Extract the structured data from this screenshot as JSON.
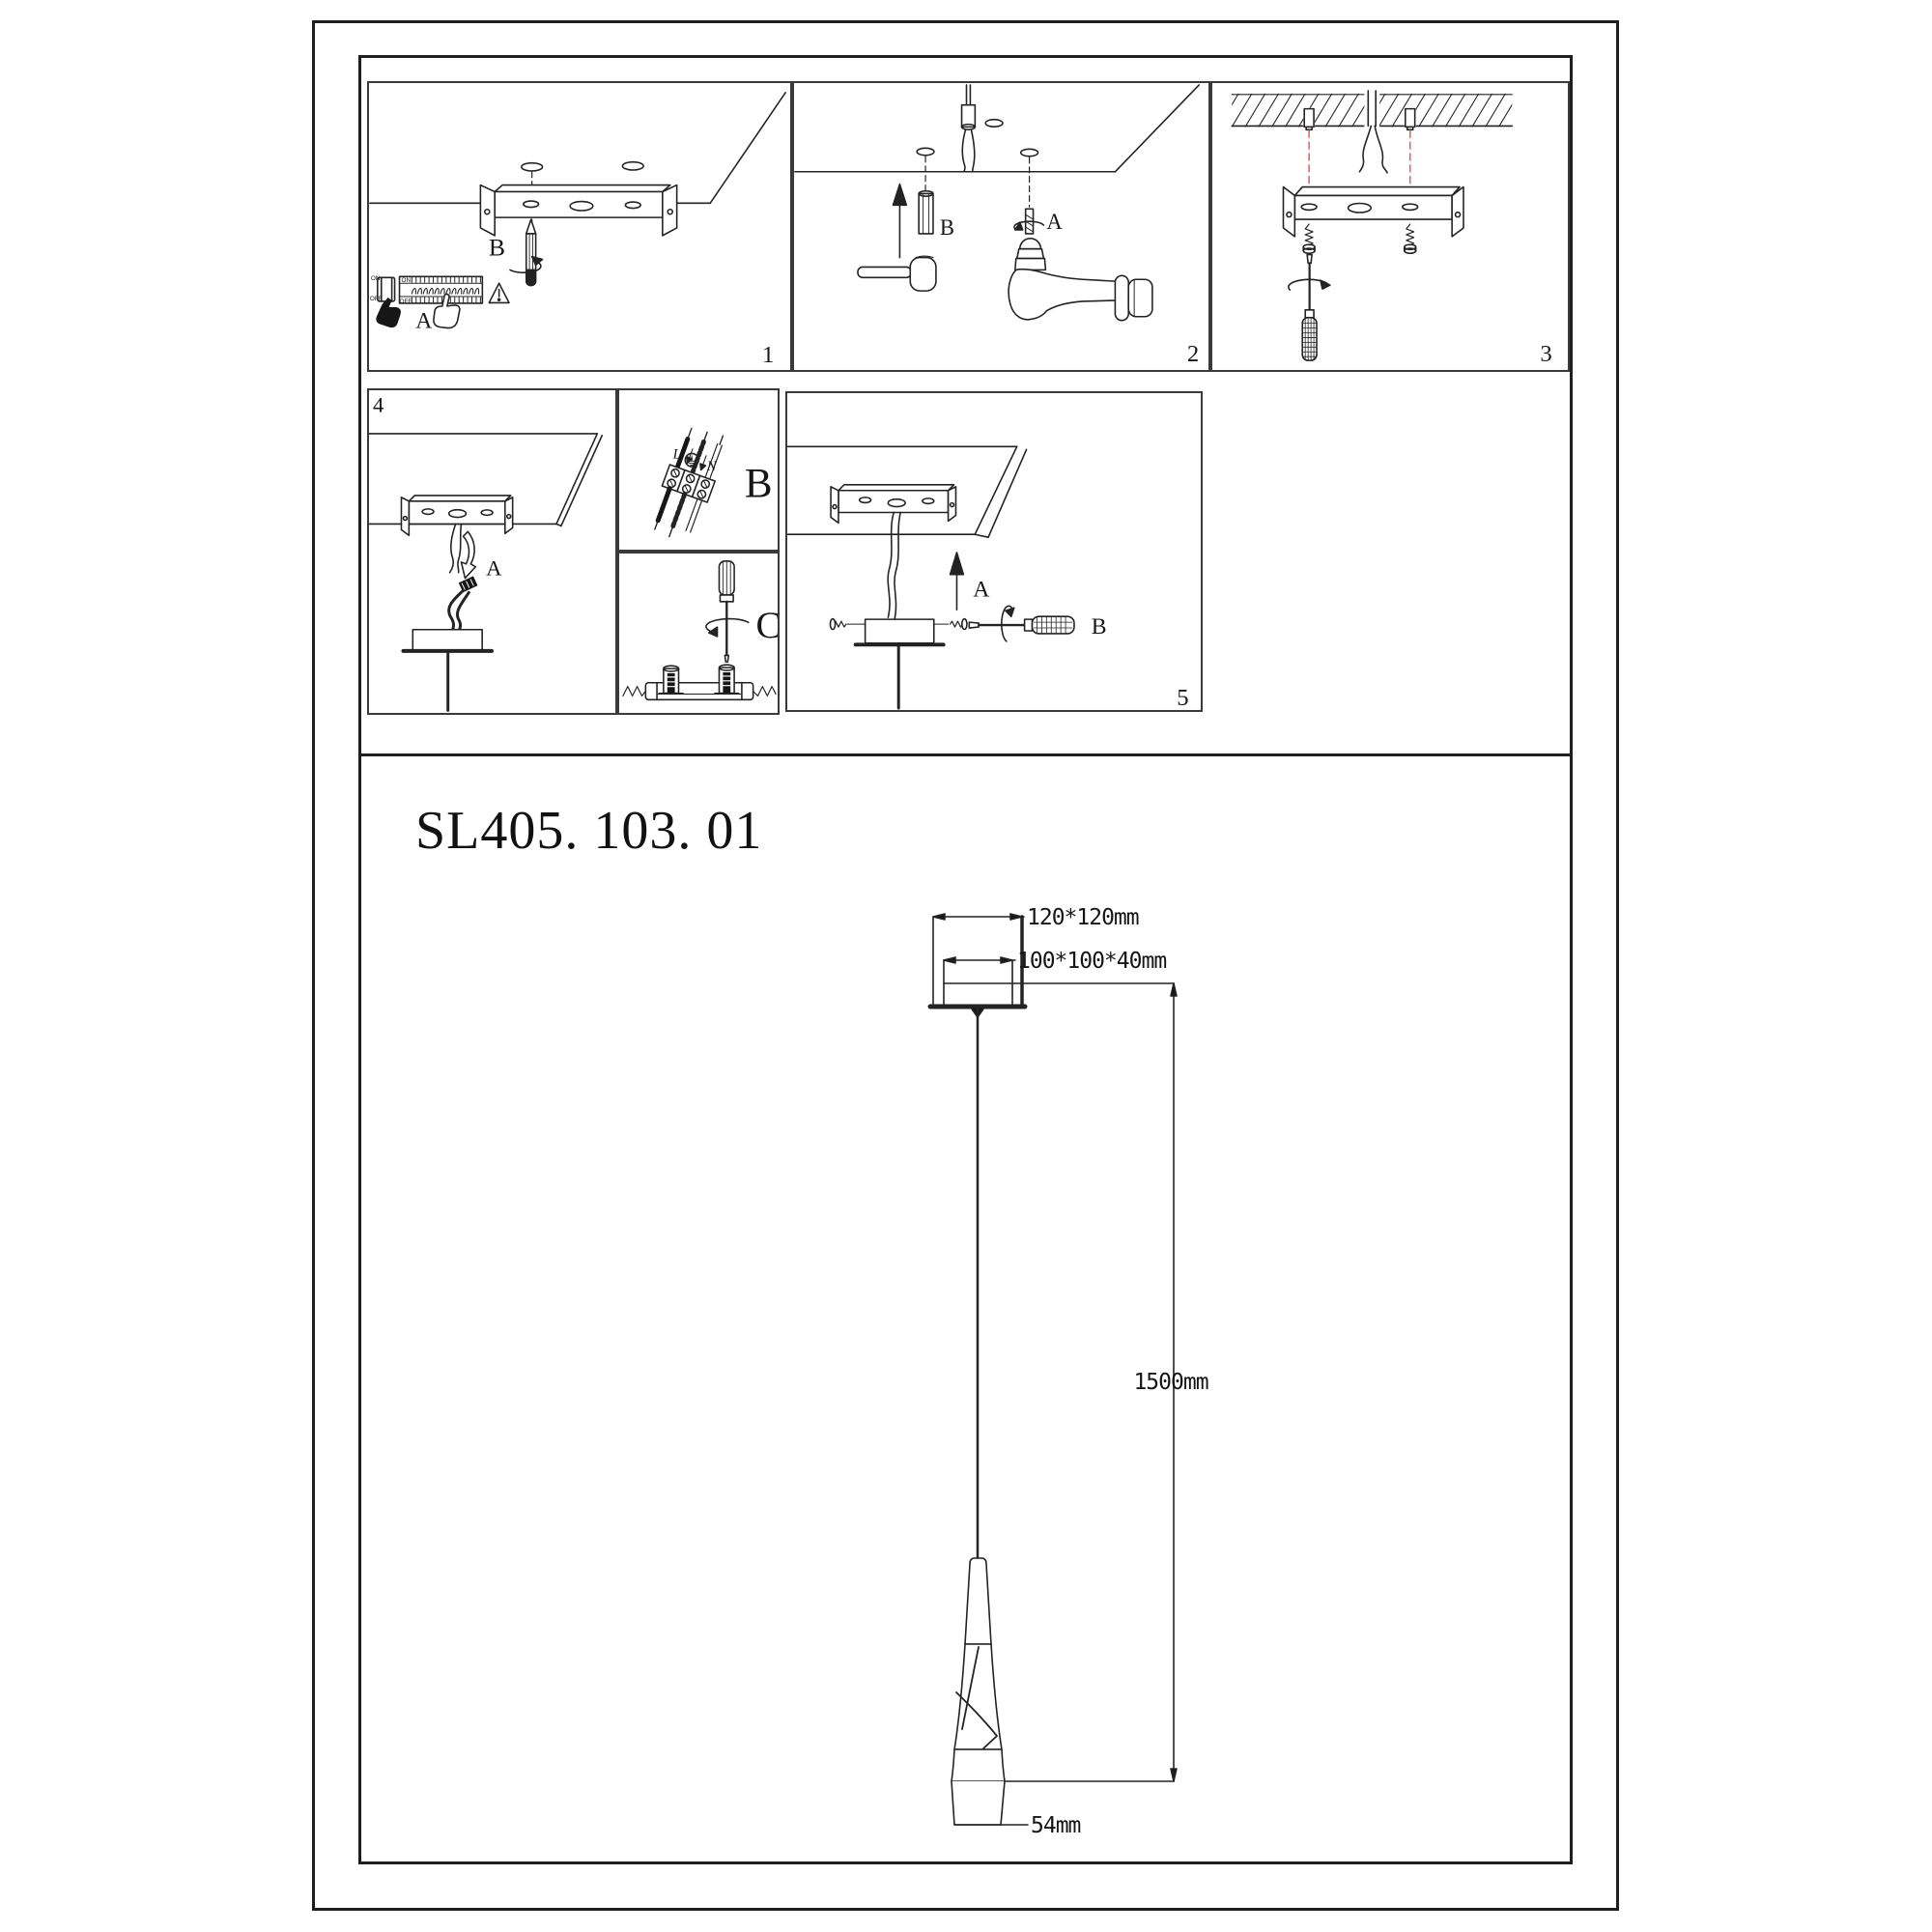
{
  "colors": {
    "ink": "#232323",
    "alignment_red": "#e06666",
    "paper": "#ffffff"
  },
  "model_number": "SL405. 103. 01",
  "steps": {
    "step1": {
      "number": "1",
      "mark_drill_label": "B",
      "power_off_label": "A",
      "switch_on": "ON",
      "switch_off": "OFF",
      "breaker_on": "ON",
      "breaker_off": "OFF"
    },
    "step2": {
      "number": "2",
      "anchor_label": "B",
      "drill_label": "A"
    },
    "step3": {
      "number": "3"
    },
    "step4": {
      "number": "4",
      "connect_label": "A"
    },
    "wiring_detail": {
      "label": "B",
      "live": "L",
      "neutral": "N"
    },
    "tighten_detail": {
      "label": "C"
    },
    "step5": {
      "number": "5",
      "lift_label": "A",
      "screw_label": "B"
    }
  },
  "dimensions": {
    "ceiling_plate": "120*120mm",
    "canopy_box": "100*100*40mm",
    "suspension_length": "1500mm",
    "shade_width": "54mm"
  }
}
